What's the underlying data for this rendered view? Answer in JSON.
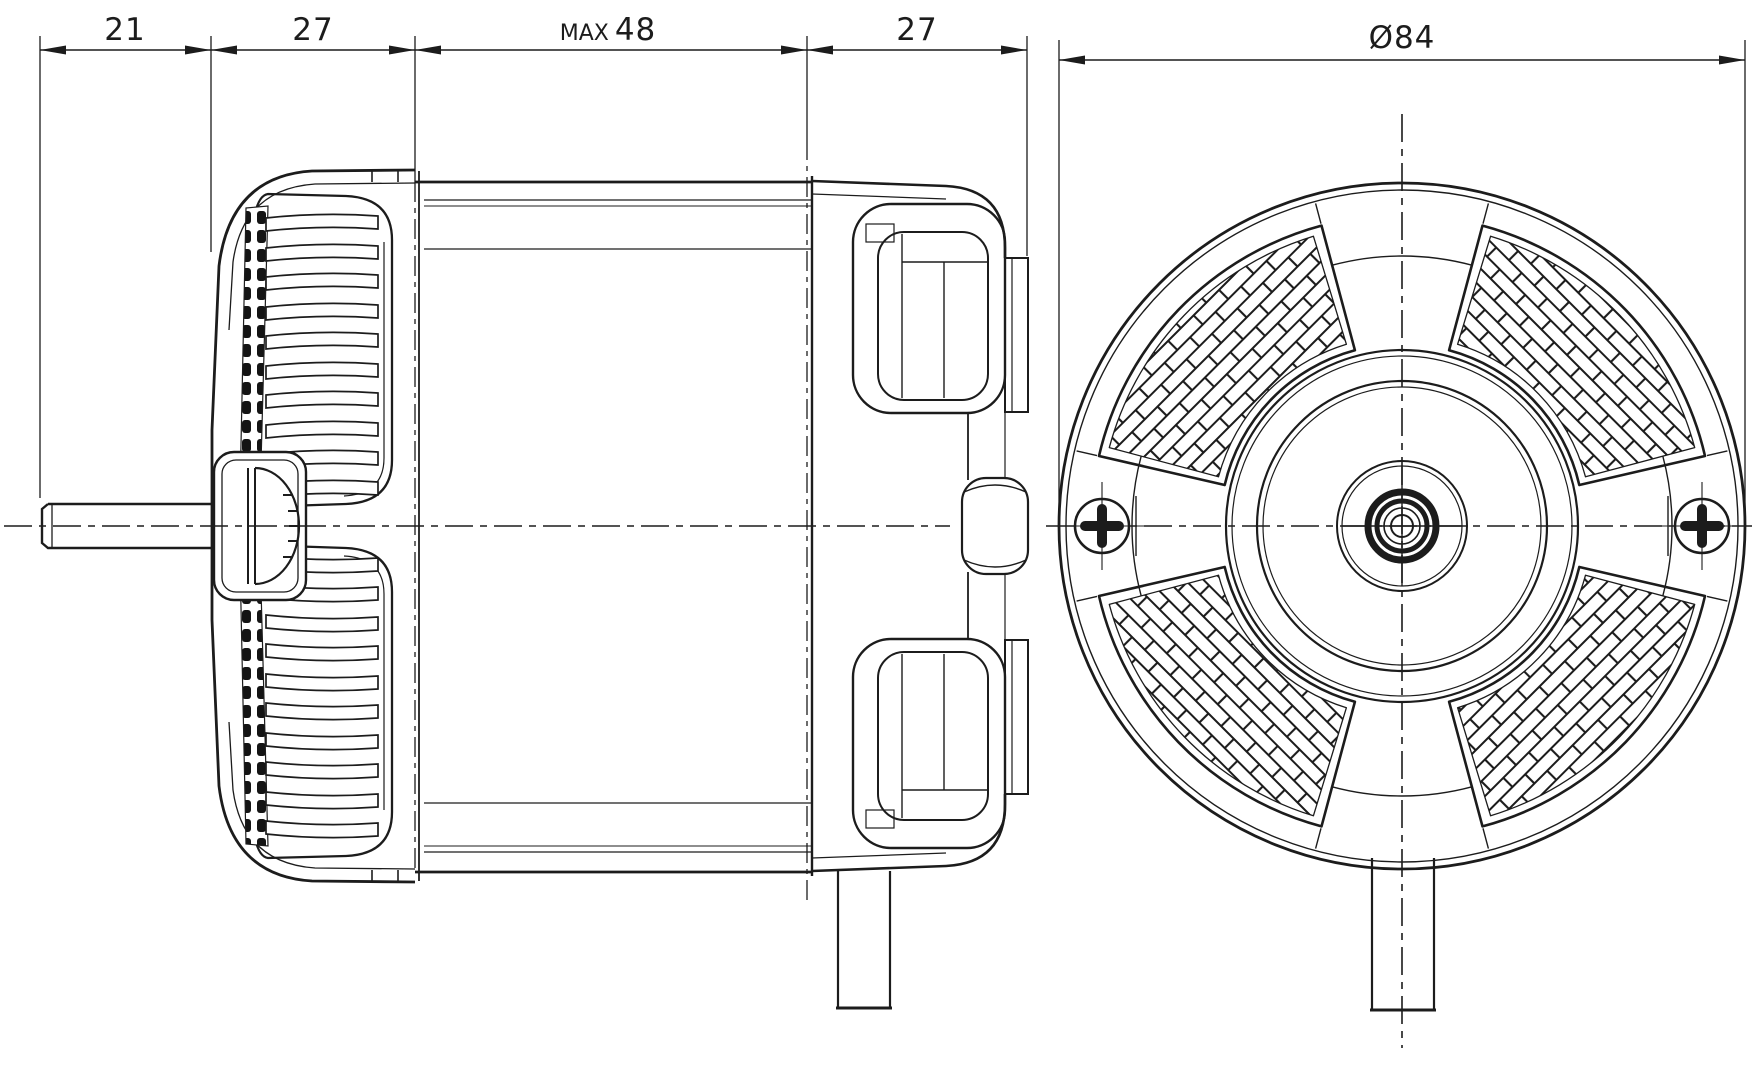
{
  "page": {
    "background": "#ffffff",
    "line_color": "#1c1c1c"
  },
  "drawing": {
    "dimensions": [
      {
        "label": "21"
      },
      {
        "label": "27"
      },
      {
        "prefix": "MAX",
        "value": "48"
      },
      {
        "label": "27"
      },
      {
        "label": "Ø84"
      }
    ]
  }
}
